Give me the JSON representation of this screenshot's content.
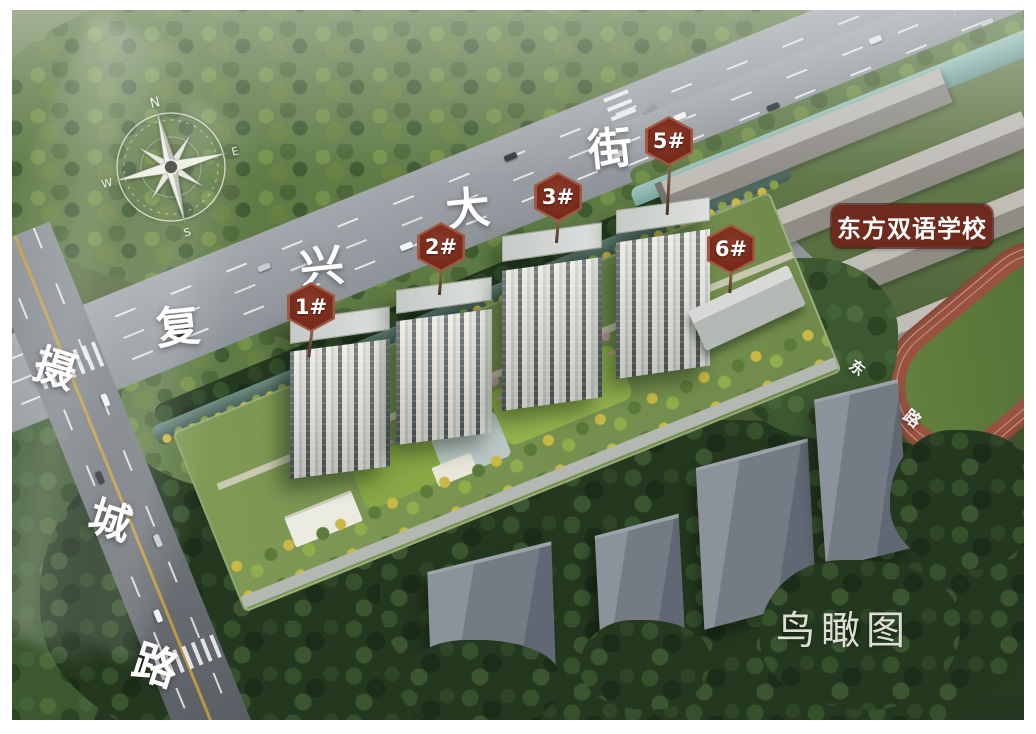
{
  "caption": "鸟瞰图",
  "school": {
    "label": "东方双语学校"
  },
  "buildings": [
    {
      "label": "1#"
    },
    {
      "label": "2#"
    },
    {
      "label": "3#"
    },
    {
      "label": "5#"
    },
    {
      "label": "6#"
    }
  ],
  "roads": {
    "fuxing": {
      "chars": [
        "复",
        "兴",
        "大",
        "街"
      ]
    },
    "shecheng": {
      "chars": [
        "摄",
        "城",
        "路"
      ]
    },
    "east": {
      "chars": [
        "东",
        "路"
      ]
    }
  },
  "compass": {
    "n": "N",
    "e": "E",
    "s": "S",
    "w": "W"
  },
  "colors": {
    "badge": "#77291B",
    "school_label_bg": "#6E2A1C",
    "label_text": "#FFFFFF",
    "road": "#969CA1",
    "water": "#5E8A84",
    "track": "#98523F",
    "field": "#5E7B3B",
    "forest_dark": "#24381F",
    "forest_light": "#5E7A45",
    "caption_text": "#E5E4DC"
  }
}
